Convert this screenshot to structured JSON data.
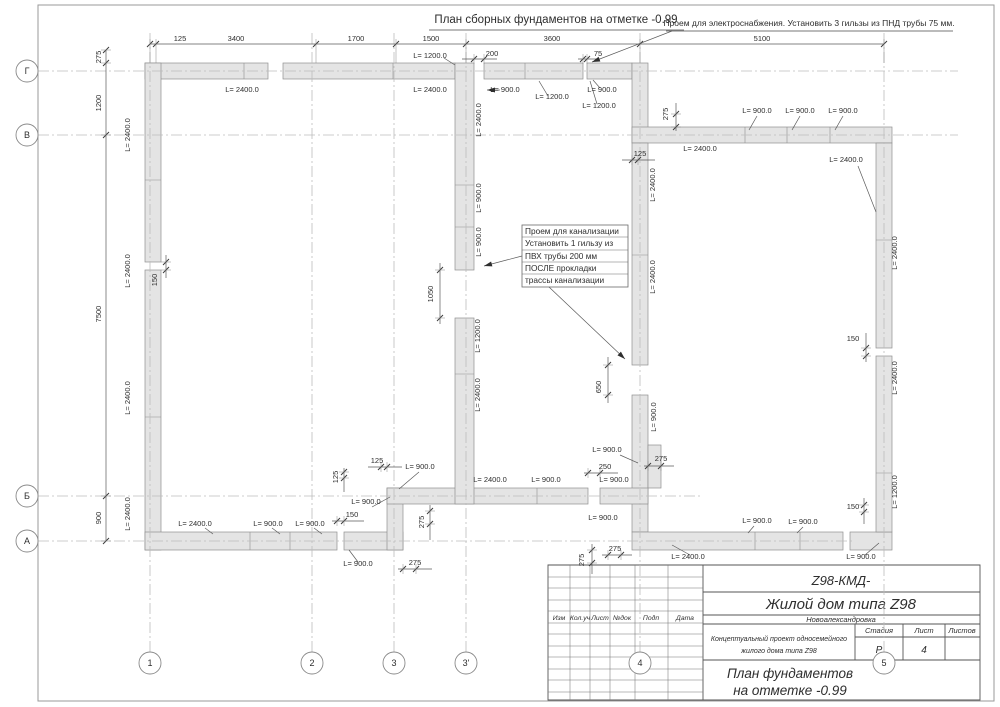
{
  "page": {
    "title": "План сборных фундаментов на отметке -0.99"
  },
  "notes": {
    "electro": "Проем для электроснабжения. Установить 3 гильзы из ПНД трубы 75 мм.",
    "kanaliz": [
      "Проем для канализации",
      "Установить 1 гильзу из",
      "ПВХ трубы 200 мм",
      "ПОСЛЕ прокладки",
      "трассы канализации"
    ]
  },
  "title_block": {
    "code": "Z98-КМД-",
    "object": "Жилой дом типа Z98",
    "location": "Новоалександровка",
    "project_line1": "Концептуальный проект односемейного",
    "project_line2": "жилого дома типа Z98",
    "stage_label": "Стадия",
    "sheet_label": "Лист",
    "sheets_label": "Листов",
    "stage_value": "Р",
    "sheet_value": "4",
    "sheets_value": "",
    "drawing_line1": "План фундаментов",
    "drawing_line2": "на отметке -0.99",
    "rev_headers": [
      "Изм",
      "Кол.уч",
      "Лист",
      "№док",
      "Подп",
      "Дата"
    ]
  },
  "drawing": {
    "axes": {
      "rows": [
        {
          "label": "Г",
          "y": 71,
          "x2": 958
        },
        {
          "label": "В",
          "y": 135,
          "x2": 958
        },
        {
          "label": "Б",
          "y": 496,
          "x2": 700
        },
        {
          "label": "А",
          "y": 541,
          "x2": 852
        }
      ],
      "cols": [
        {
          "label": "1",
          "x": 150
        },
        {
          "label": "2",
          "x": 312
        },
        {
          "label": "3",
          "x": 394
        },
        {
          "label": "3'",
          "x": 466
        },
        {
          "label": "4",
          "x": 640
        },
        {
          "label": "5",
          "x": 884
        }
      ]
    },
    "walls": [
      [
        145,
        63,
        123,
        16
      ],
      [
        283,
        63,
        172,
        16
      ],
      [
        484,
        63,
        99,
        16
      ],
      [
        587,
        63,
        45,
        16
      ],
      [
        632,
        63,
        16,
        80
      ],
      [
        632,
        127,
        260,
        16
      ],
      [
        632,
        143,
        16,
        222
      ],
      [
        632,
        395,
        16,
        137
      ],
      [
        648,
        445,
        13,
        43
      ],
      [
        632,
        532,
        211,
        18
      ],
      [
        850,
        532,
        42,
        18
      ],
      [
        876,
        143,
        16,
        205
      ],
      [
        876,
        356,
        16,
        176
      ],
      [
        145,
        63,
        16,
        199
      ],
      [
        145,
        270,
        16,
        280
      ],
      [
        145,
        532,
        192,
        18
      ],
      [
        344,
        532,
        59,
        18
      ],
      [
        387,
        488,
        16,
        62
      ],
      [
        387,
        488,
        201,
        16
      ],
      [
        600,
        488,
        48,
        16
      ],
      [
        455,
        63,
        19,
        207
      ],
      [
        455,
        318,
        19,
        186
      ]
    ],
    "joints_path": "M244 63v16 M393 63v16 M525 63v16 M745 127v16 M787 127v16 M830 127v16 M145 180h16 M145 417h16 M455 185h19 M455 227h19 M455 374h19 M632 255h16 M876 240h16 M876 473h16 M537 488v16 M250 532v18 M290 532v18 M755 532v18 M800 532v18",
    "dims": [
      {
        "o": "h",
        "p": 44,
        "a": 150,
        "b": 884,
        "t": [
          150,
          156,
          316,
          396,
          466,
          640,
          884
        ],
        "w": 19
      },
      {
        "o": "h",
        "p": 59,
        "a": 462,
        "b": 497,
        "t": [
          474,
          484
        ]
      },
      {
        "o": "h",
        "p": 59,
        "a": 578,
        "b": 600,
        "t": [
          583,
          587
        ]
      },
      {
        "o": "v",
        "p": 106,
        "a": 50,
        "b": 541,
        "t": [
          50,
          63,
          135,
          496,
          541
        ]
      },
      {
        "o": "v",
        "p": 166,
        "a": 255,
        "b": 278,
        "t": [
          262,
          270
        ]
      },
      {
        "o": "v",
        "p": 440,
        "a": 263,
        "b": 324,
        "t": [
          270,
          318
        ]
      },
      {
        "o": "v",
        "p": 608,
        "a": 357,
        "b": 403,
        "t": [
          365,
          395
        ]
      },
      {
        "o": "h",
        "p": 467,
        "a": 368,
        "b": 402,
        "t": [
          381,
          387
        ]
      },
      {
        "o": "v",
        "p": 344,
        "a": 468,
        "b": 492,
        "t": [
          472,
          478
        ]
      },
      {
        "o": "h",
        "p": 521,
        "a": 332,
        "b": 364,
        "t": [
          337,
          344
        ]
      },
      {
        "o": "h",
        "p": 473,
        "a": 584,
        "b": 618,
        "t": [
          588,
          600
        ]
      },
      {
        "o": "h",
        "p": 466,
        "a": 644,
        "b": 674,
        "t": [
          648,
          661
        ]
      },
      {
        "o": "h",
        "p": 555,
        "a": 602,
        "b": 632,
        "t": [
          608,
          621
        ]
      },
      {
        "o": "v",
        "p": 592,
        "a": 544,
        "b": 574,
        "t": [
          550,
          563
        ]
      },
      {
        "o": "v",
        "p": 430,
        "a": 505,
        "b": 540,
        "t": [
          511,
          524
        ]
      },
      {
        "o": "h",
        "p": 569,
        "a": 398,
        "b": 432,
        "t": [
          403,
          416
        ]
      },
      {
        "o": "h",
        "p": 160,
        "a": 622,
        "b": 655,
        "t": [
          632,
          638
        ]
      },
      {
        "o": "v",
        "p": 676,
        "a": 103,
        "b": 131,
        "t": [
          114,
          127
        ]
      },
      {
        "o": "v",
        "p": 866,
        "a": 333,
        "b": 362,
        "t": [
          348,
          356
        ]
      },
      {
        "o": "v",
        "p": 864,
        "a": 498,
        "b": 524,
        "t": [
          505,
          512
        ]
      }
    ],
    "leaders": [
      {
        "x1": 672,
        "y1": 31,
        "x2": 592,
        "y2": 62,
        "ar": 1
      },
      {
        "x1": 522,
        "y1": 256,
        "x2": 484,
        "y2": 266,
        "ar": 1
      },
      {
        "x1": 549,
        "y1": 287,
        "x2": 625,
        "y2": 359,
        "ar": 1
      },
      {
        "x1": 500,
        "y1": 90,
        "x2": 487,
        "y2": 90,
        "ar": 1
      },
      {
        "x1": 444,
        "y1": 58,
        "x2": 455,
        "y2": 65
      },
      {
        "x1": 548,
        "y1": 96,
        "x2": 539,
        "y2": 81
      },
      {
        "x1": 597,
        "y1": 104,
        "x2": 590,
        "y2": 81
      },
      {
        "x1": 600,
        "y1": 88,
        "x2": 593,
        "y2": 80
      },
      {
        "x1": 757,
        "y1": 116,
        "x2": 749,
        "y2": 130
      },
      {
        "x1": 800,
        "y1": 116,
        "x2": 792,
        "y2": 130
      },
      {
        "x1": 843,
        "y1": 116,
        "x2": 835,
        "y2": 130
      },
      {
        "x1": 858,
        "y1": 166,
        "x2": 876,
        "y2": 212
      },
      {
        "x1": 620,
        "y1": 455,
        "x2": 638,
        "y2": 463
      },
      {
        "x1": 419,
        "y1": 472,
        "x2": 399,
        "y2": 489
      },
      {
        "x1": 372,
        "y1": 507,
        "x2": 390,
        "y2": 497
      },
      {
        "x1": 358,
        "y1": 562,
        "x2": 349,
        "y2": 550
      },
      {
        "x1": 865,
        "y1": 555,
        "x2": 879,
        "y2": 543
      },
      {
        "x1": 690,
        "y1": 555,
        "x2": 672,
        "y2": 545
      },
      {
        "x1": 754,
        "y1": 526,
        "x2": 748,
        "y2": 533
      },
      {
        "x1": 803,
        "y1": 527,
        "x2": 797,
        "y2": 533
      },
      {
        "x1": 205,
        "y1": 528,
        "x2": 213,
        "y2": 534
      },
      {
        "x1": 272,
        "y1": 528,
        "x2": 280,
        "y2": 534
      },
      {
        "x1": 314,
        "y1": 528,
        "x2": 322,
        "y2": 534
      }
    ],
    "labels": [
      {
        "t": "125",
        "x": 180,
        "y": 41
      },
      {
        "t": "3400",
        "x": 236,
        "y": 41
      },
      {
        "t": "1700",
        "x": 356,
        "y": 41
      },
      {
        "t": "1500",
        "x": 431,
        "y": 41
      },
      {
        "t": "3600",
        "x": 552,
        "y": 41
      },
      {
        "t": "5100",
        "x": 762,
        "y": 41
      },
      {
        "t": "200",
        "x": 492,
        "y": 56
      },
      {
        "t": "75",
        "x": 598,
        "y": 56
      },
      {
        "t": "275",
        "x": 101,
        "y": 57,
        "r": 1
      },
      {
        "t": "1200",
        "x": 101,
        "y": 103,
        "r": 1
      },
      {
        "t": "7500",
        "x": 101,
        "y": 314,
        "r": 1
      },
      {
        "t": "900",
        "x": 101,
        "y": 518,
        "r": 1
      },
      {
        "t": "L= 2400.0",
        "x": 242,
        "y": 92
      },
      {
        "t": "L= 2400.0",
        "x": 430,
        "y": 92
      },
      {
        "t": "L= 1200.0",
        "x": 430,
        "y": 58
      },
      {
        "t": "L= 900.0",
        "x": 505,
        "y": 92
      },
      {
        "t": "L= 1200.0",
        "x": 552,
        "y": 99
      },
      {
        "t": "L= 900.0",
        "x": 602,
        "y": 92
      },
      {
        "t": "L= 1200.0",
        "x": 599,
        "y": 108
      },
      {
        "t": "125",
        "x": 640,
        "y": 156
      },
      {
        "t": "275",
        "x": 668,
        "y": 114,
        "r": 1
      },
      {
        "t": "L= 900.0",
        "x": 757,
        "y": 113
      },
      {
        "t": "L= 900.0",
        "x": 800,
        "y": 113
      },
      {
        "t": "L= 900.0",
        "x": 843,
        "y": 113
      },
      {
        "t": "L= 2400.0",
        "x": 700,
        "y": 151
      },
      {
        "t": "L= 2400.0",
        "x": 846,
        "y": 162
      },
      {
        "t": "L= 2400.0",
        "x": 655,
        "y": 185,
        "r": 1
      },
      {
        "t": "L= 2400.0",
        "x": 655,
        "y": 277,
        "r": 1
      },
      {
        "t": "L= 2400.0",
        "x": 897,
        "y": 253,
        "r": 1
      },
      {
        "t": "150",
        "x": 853,
        "y": 341
      },
      {
        "t": "L= 2400.0",
        "x": 897,
        "y": 378,
        "r": 1
      },
      {
        "t": "L= 1200.0",
        "x": 897,
        "y": 492,
        "r": 1
      },
      {
        "t": "150",
        "x": 853,
        "y": 509
      },
      {
        "t": "L= 900.0",
        "x": 861,
        "y": 559
      },
      {
        "t": "L= 900.0",
        "x": 757,
        "y": 523
      },
      {
        "t": "L= 900.0",
        "x": 803,
        "y": 524
      },
      {
        "t": "L= 2400.0",
        "x": 688,
        "y": 559
      },
      {
        "t": "650",
        "x": 601,
        "y": 387,
        "r": 1
      },
      {
        "t": "L= 900.0",
        "x": 656,
        "y": 417,
        "r": 1
      },
      {
        "t": "L= 900.0",
        "x": 607,
        "y": 452
      },
      {
        "t": "275",
        "x": 661,
        "y": 461
      },
      {
        "t": "250",
        "x": 605,
        "y": 469
      },
      {
        "t": "L= 900.0",
        "x": 614,
        "y": 482
      },
      {
        "t": "L= 900.0",
        "x": 603,
        "y": 520
      },
      {
        "t": "275",
        "x": 615,
        "y": 551
      },
      {
        "t": "275",
        "x": 584,
        "y": 560,
        "r": 1
      },
      {
        "t": "L= 2400.0",
        "x": 490,
        "y": 482
      },
      {
        "t": "L= 900.0",
        "x": 546,
        "y": 482
      },
      {
        "t": "125",
        "x": 377,
        "y": 463
      },
      {
        "t": "125",
        "x": 338,
        "y": 477,
        "r": 1
      },
      {
        "t": "L= 900.0",
        "x": 420,
        "y": 469
      },
      {
        "t": "L= 900.0",
        "x": 366,
        "y": 504
      },
      {
        "t": "150",
        "x": 352,
        "y": 517
      },
      {
        "t": "275",
        "x": 424,
        "y": 522,
        "r": 1
      },
      {
        "t": "275",
        "x": 415,
        "y": 565
      },
      {
        "t": "L= 900.0",
        "x": 358,
        "y": 566
      },
      {
        "t": "L= 2400.0",
        "x": 195,
        "y": 526
      },
      {
        "t": "L= 900.0",
        "x": 268,
        "y": 526
      },
      {
        "t": "L= 900.0",
        "x": 310,
        "y": 526
      },
      {
        "t": "L= 2400.0",
        "x": 130,
        "y": 135,
        "r": 1
      },
      {
        "t": "L= 2400.0",
        "x": 130,
        "y": 271,
        "r": 1
      },
      {
        "t": "150",
        "x": 157,
        "y": 280,
        "r": 1
      },
      {
        "t": "L= 2400.0",
        "x": 130,
        "y": 398,
        "r": 1
      },
      {
        "t": "L= 2400.0",
        "x": 130,
        "y": 514,
        "r": 1
      },
      {
        "t": "L= 2400.0",
        "x": 481,
        "y": 120,
        "r": 1
      },
      {
        "t": "L= 900.0",
        "x": 481,
        "y": 198,
        "r": 1
      },
      {
        "t": "L= 900.0",
        "x": 481,
        "y": 242,
        "r": 1
      },
      {
        "t": "1050",
        "x": 433,
        "y": 294,
        "r": 1
      },
      {
        "t": "L= 1200.0",
        "x": 480,
        "y": 336,
        "r": 1
      },
      {
        "t": "L= 2400.0",
        "x": 480,
        "y": 395,
        "r": 1
      }
    ]
  }
}
